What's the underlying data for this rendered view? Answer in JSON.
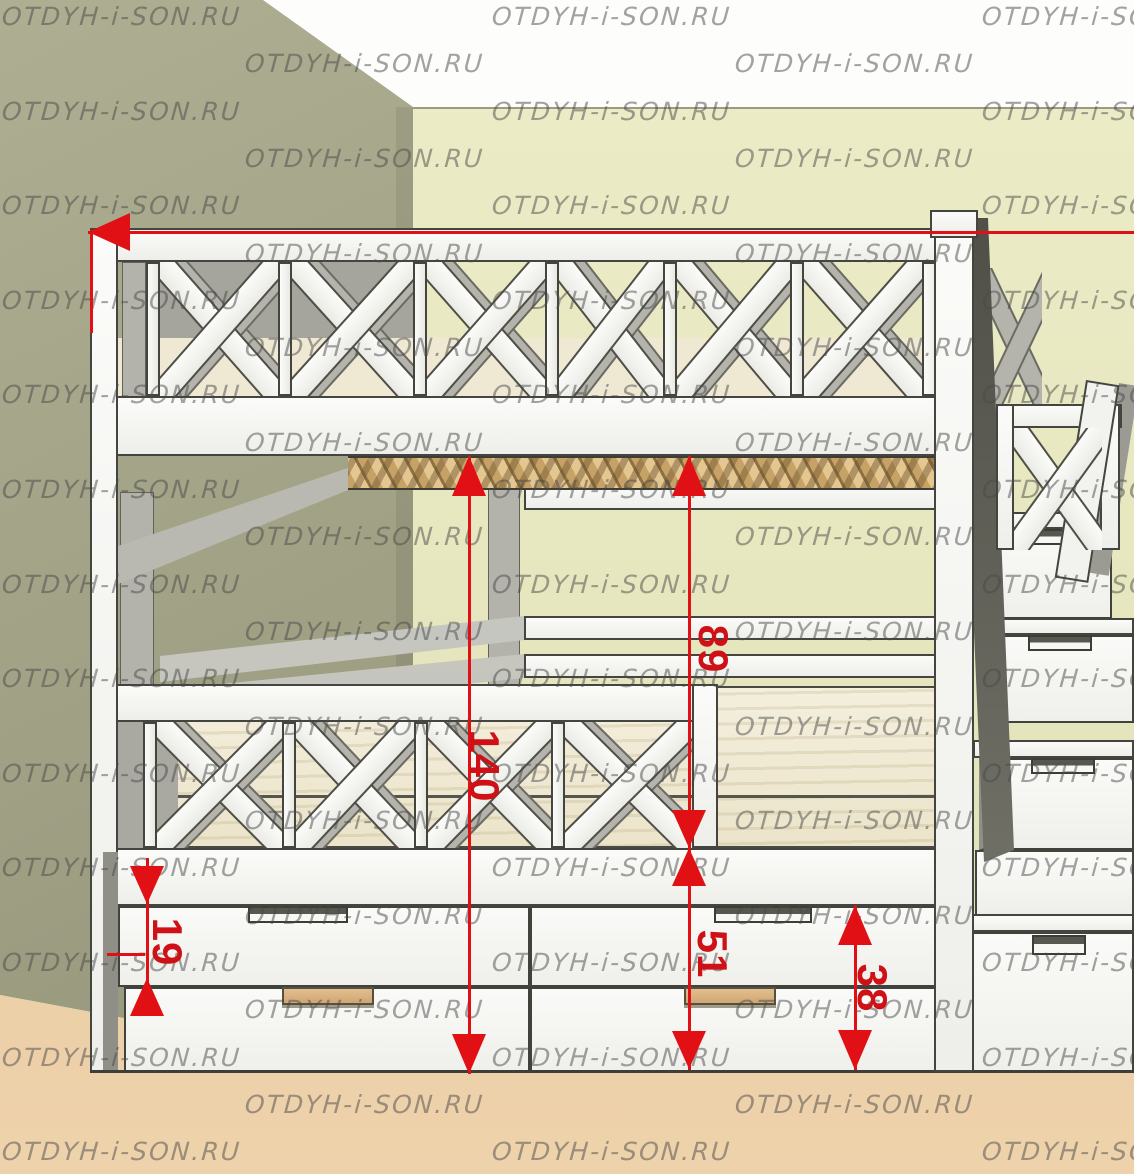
{
  "watermark": {
    "text": "OTDYH-i-SON.RU"
  },
  "dimensions": {
    "total_height": "140",
    "upper_bunk_clearance": "89",
    "lower_bunk_clearance": "51",
    "drawer_height": "19",
    "drawer_block_height": "38"
  },
  "colors": {
    "dimension_red": "#e01015",
    "left_wall": "#a3a388",
    "back_wall": "#e9e9c2",
    "floor": "#e7c9a1",
    "furniture_white": "#f6f6f3",
    "slat_wood": "#d4b279",
    "mattress_wood": "#f2edda"
  }
}
